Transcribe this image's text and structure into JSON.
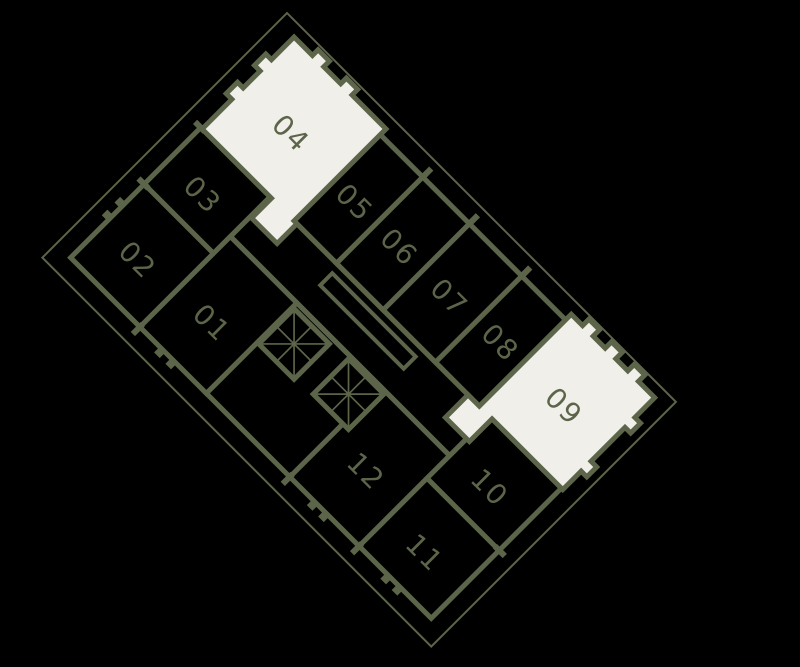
{
  "plan": {
    "title": "residential-floor-plan",
    "colors": {
      "background": "#000000",
      "wall": "#5c6549",
      "highlight": "#f0efe9",
      "label": "#5c6549"
    },
    "units": [
      {
        "number": "01",
        "highlighted": false
      },
      {
        "number": "02",
        "highlighted": false
      },
      {
        "number": "03",
        "highlighted": false
      },
      {
        "number": "04",
        "highlighted": true
      },
      {
        "number": "05",
        "highlighted": false
      },
      {
        "number": "06",
        "highlighted": false
      },
      {
        "number": "07",
        "highlighted": false
      },
      {
        "number": "08",
        "highlighted": false
      },
      {
        "number": "09",
        "highlighted": true
      },
      {
        "number": "10",
        "highlighted": false
      },
      {
        "number": "11",
        "highlighted": false
      },
      {
        "number": "12",
        "highlighted": false
      }
    ]
  }
}
